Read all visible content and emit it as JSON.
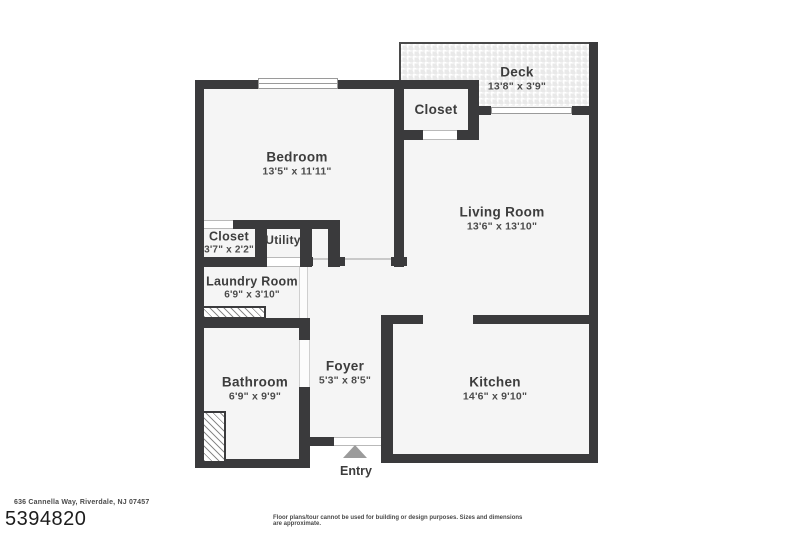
{
  "colors": {
    "wall": "#3a3a3c",
    "floor": "#f5f5f5",
    "label": "#3d3d3d",
    "entry_arrow": "#9b9b9b"
  },
  "rooms": {
    "bedroom": {
      "name": "Bedroom",
      "dims": "13'5\" x 11'11\""
    },
    "closet_upper": {
      "name": "Closet"
    },
    "deck": {
      "name": "Deck",
      "dims": "13'8\" x 3'9\""
    },
    "living_room": {
      "name": "Living Room",
      "dims": "13'6\" x 13'10\""
    },
    "closet_lower": {
      "name": "Closet",
      "dims": "3'7\" x 2'2\""
    },
    "utility": {
      "name": "Utility"
    },
    "laundry": {
      "name": "Laundry Room",
      "dims": "6'9\" x 3'10\""
    },
    "bathroom": {
      "name": "Bathroom",
      "dims": "6'9\" x 9'9\""
    },
    "foyer": {
      "name": "Foyer",
      "dims": "5'3\" x 8'5\""
    },
    "kitchen": {
      "name": "Kitchen",
      "dims": "14'6\" x 9'10\""
    }
  },
  "entry": {
    "label": "Entry"
  },
  "footer": {
    "address": "636 Cannella Way, Riverdale, NJ 07457",
    "listing_id": "5394820",
    "disclaimer": "Floor plans/tour cannot be used for building or design purposes. Sizes and dimensions are approximate."
  }
}
